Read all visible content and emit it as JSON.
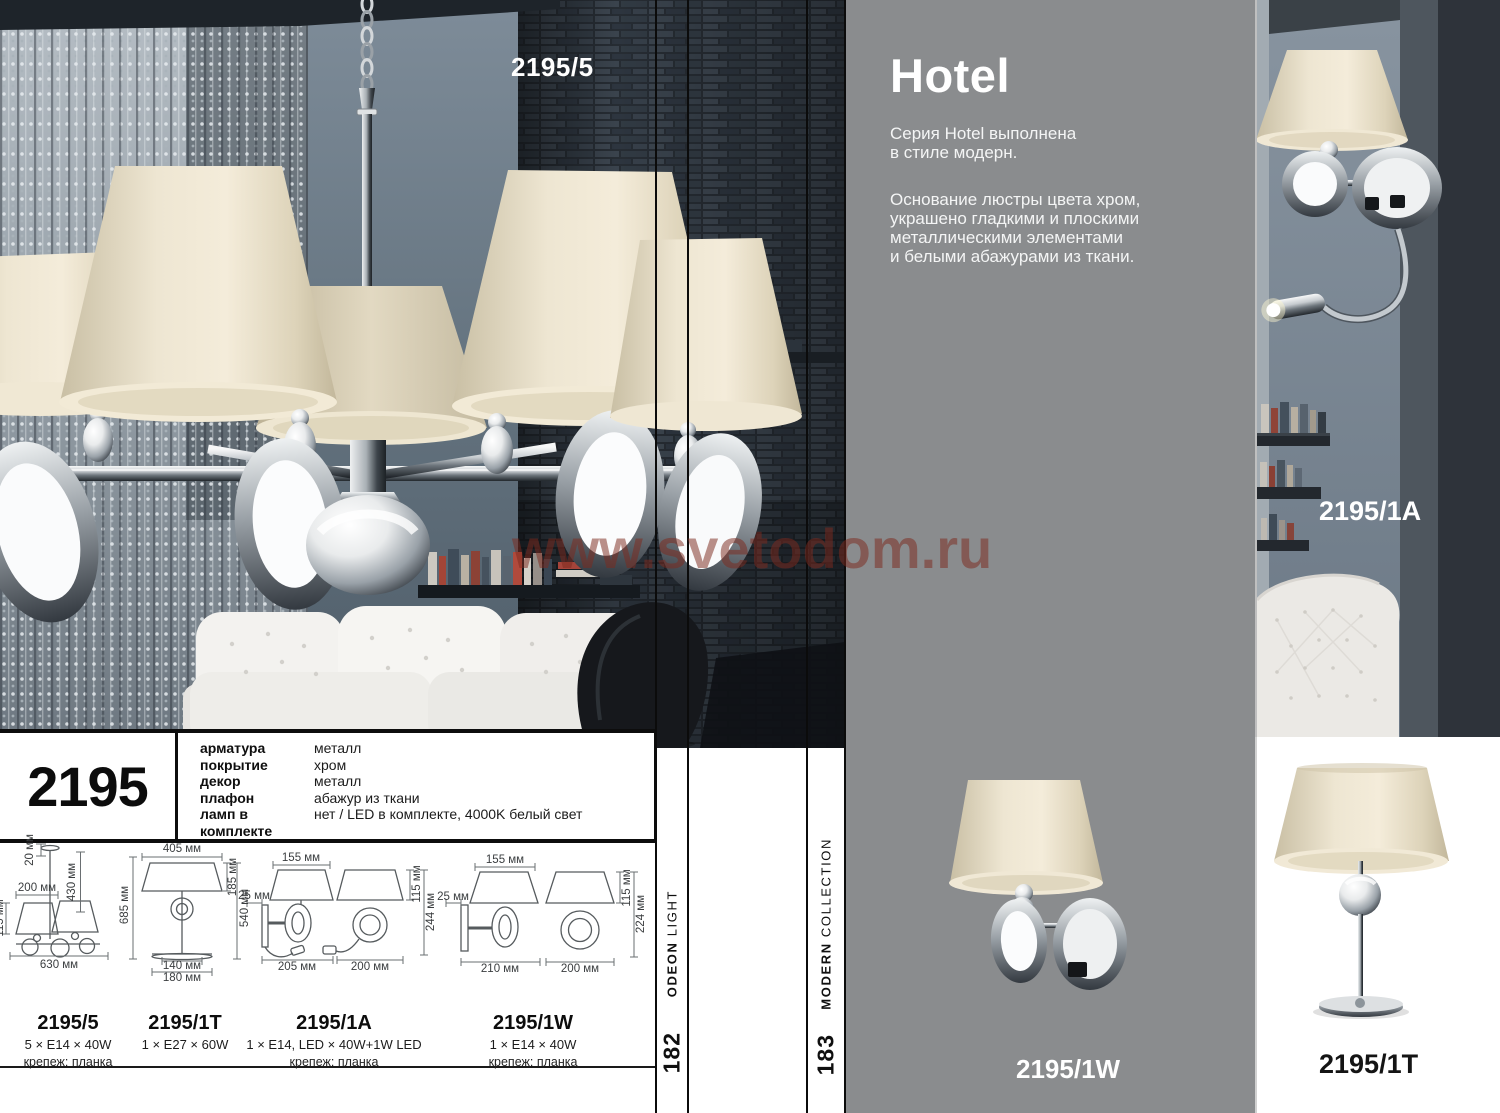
{
  "photo": {
    "label": "2195/5"
  },
  "watermark": "www.svetodom.ru",
  "series": {
    "title": "Hotel",
    "intro": "Серия Hotel выполнена\nв стиле модерн.",
    "description": "Основание люстры цвета хром,\nукрашено гладкими и плоскими\nметаллическими элементами\nи белыми абажурами из ткани."
  },
  "specs": {
    "model": "2195",
    "rows": [
      {
        "label": "арматура",
        "value": "металл"
      },
      {
        "label": "покрытие",
        "value": "хром"
      },
      {
        "label": "декор",
        "value": "металл"
      },
      {
        "label": "плафон",
        "value": "абажур из ткани"
      },
      {
        "label": "ламп в комплекте",
        "value": "нет / LED в комплекте, 4000K белый свет"
      }
    ]
  },
  "drawings": {
    "chandelier": {
      "hang": "20 мм",
      "height": "430 мм",
      "shade_width": "200 мм",
      "shade_height": "115 мм",
      "width": "630 мм"
    },
    "table": {
      "shade_width": "405 мм",
      "total_height": "685 мм",
      "shade_height": "185 мм",
      "body_height": "540 мм",
      "base_inner": "140 мм",
      "base": "180 мм"
    },
    "wall_a": {
      "shade_width": "155 мм",
      "bracket": "25 мм",
      "depth": "205 мм",
      "width": "200 мм",
      "shade_height": "115 мм",
      "total_height": "244 мм"
    },
    "wall_w": {
      "shade_width": "155 мм",
      "bracket": "25 мм",
      "depth": "210 мм",
      "width": "200 мм",
      "shade_height": "115 мм",
      "total_height": "224 мм"
    }
  },
  "variants": [
    {
      "code": "2195/5",
      "lamps": "5 × E14 × 40W",
      "mount": "крепеж: планка"
    },
    {
      "code": "2195/1T",
      "lamps": "1 × E27 × 60W",
      "mount": ""
    },
    {
      "code": "2195/1A",
      "lamps": "1 × E14, LED × 40W+1W LED",
      "mount": "крепеж: планка"
    },
    {
      "code": "2195/1W",
      "lamps": "1 × E14 × 40W",
      "mount": "крепеж: планка"
    }
  ],
  "sidebar_left": {
    "brand": "ODEON",
    "brand2": "LIGHT",
    "page": "182"
  },
  "sidebar_right": {
    "brand": "MODERN",
    "brand2": "COLLECTION",
    "page": "183"
  },
  "products": {
    "wall_a": "2195/1A",
    "wall_w": "2195/1W",
    "table": "2195/1T"
  },
  "colors": {
    "panel_gray": "#8a8c8e",
    "watermark_red": "#7c2a1e",
    "shade_cream": "#eee6d2",
    "wall_blue": "#64737f",
    "stone_dark": "#262c33"
  }
}
